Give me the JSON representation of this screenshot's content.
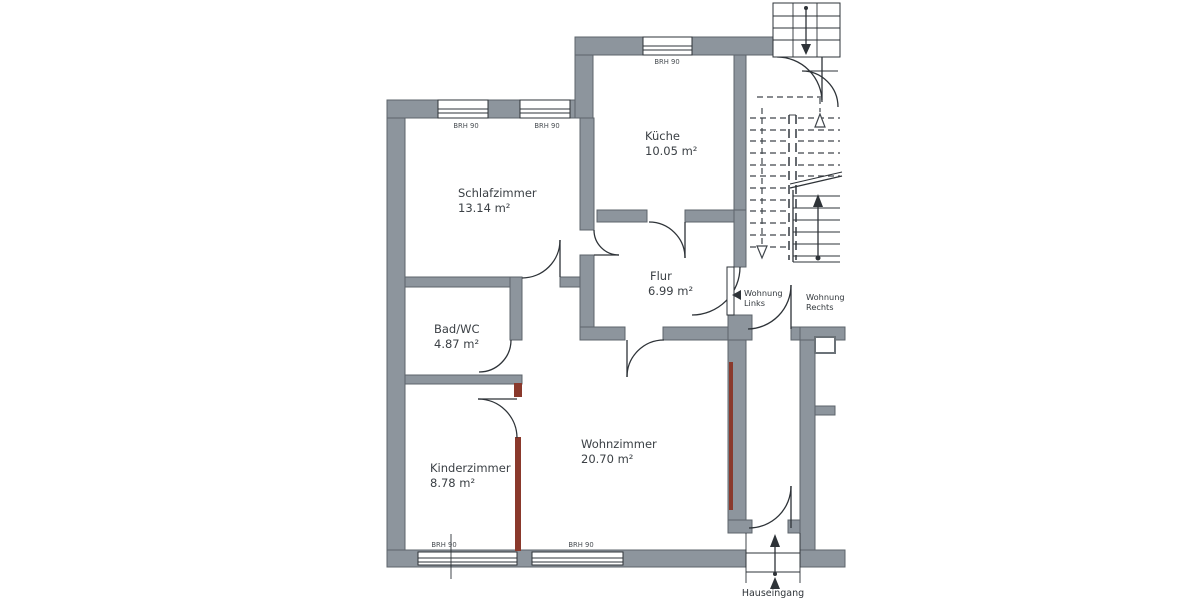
{
  "document": {
    "type": "floor-plan",
    "description_visible_only": "apartment floor plan scan"
  },
  "rooms": {
    "schlafzimmer": {
      "name": "Schlafzimmer",
      "area": "13.14 m²"
    },
    "kueche": {
      "name": "Küche",
      "area": "10.05 m²"
    },
    "flur": {
      "name": "Flur",
      "area": "6.99 m²"
    },
    "bad_wc": {
      "name": "Bad/WC",
      "area": "4.87 m²"
    },
    "kinderzimmer": {
      "name": "Kinderzimmer",
      "area": "8.78 m²"
    },
    "wohnzimmer": {
      "name": "Wohnzimmer",
      "area": "20.70 m²"
    }
  },
  "annotations": {
    "window_sill": "BRH 90",
    "apartment_left": {
      "line1": "Wohnung",
      "line2": "Links"
    },
    "apartment_right": {
      "line1": "Wohnung",
      "line2": "Rechts"
    },
    "house_entrance": "Hauseingang"
  },
  "colors": {
    "wall": "#8d959d",
    "wall_outline": "#5d646b",
    "line": "#2e3338",
    "new_wall_red": "#8a392c",
    "background": "#ffffff",
    "text": "#3b4045"
  }
}
